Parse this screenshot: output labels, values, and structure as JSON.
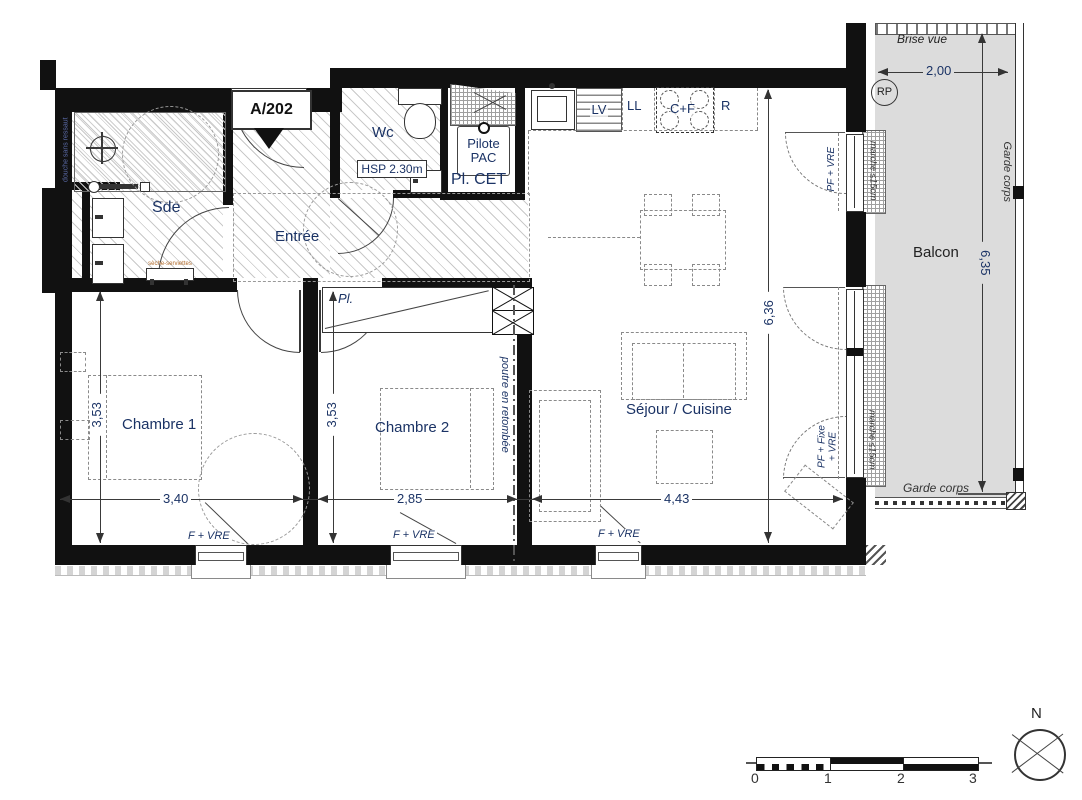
{
  "unit": {
    "label": "A/202"
  },
  "rooms": {
    "sde": "Sde",
    "entree": "Entrée",
    "wc": "Wc",
    "sejour": "Séjour / Cuisine",
    "chambre1": "Chambre 1",
    "chambre2": "Chambre 2",
    "balcon": "Balcon"
  },
  "kitchen": {
    "lv": "LV",
    "ll": "LL",
    "cf": "C+F",
    "r": "R"
  },
  "annotations": {
    "hsp": "HSP 2.30m",
    "pilote_pac": "Pilote PAC",
    "pl_cet": "Pl. CET",
    "pl": "Pl.",
    "poutre": "poutre en retombée",
    "douche": "douche sans ressaut",
    "seche": "sèche-serviettes",
    "brise_vue": "Brise vue",
    "garde_corps_right": "Garde corps",
    "garde_corps_bottom": "Garde corps",
    "rp": "RP",
    "marche_top": "marche ≤15cm",
    "marche_bottom": "marche ≤15cm",
    "pf_vre": "PF + VRE",
    "pf_fixe_vre_1": "PF + Fixe",
    "pf_fixe_vre_2": "+ VRE",
    "f_vre_1": "F + VRE",
    "f_vre_2": "F + VRE",
    "f_vre_3": "F + VRE"
  },
  "dimensions": {
    "ch1_h": "3,53",
    "ch1_w": "3,40",
    "ch2_h": "3,53",
    "ch2_w": "2,85",
    "sej_w": "4,43",
    "sej_h": "6,36",
    "bal_w": "2,00",
    "bal_h": "6,35"
  },
  "scale_bar": {
    "ticks": [
      "0",
      "1",
      "2",
      "3"
    ]
  },
  "compass": {
    "north": "N"
  },
  "colors": {
    "wall": "#111111",
    "label_navy": "#1b3365",
    "balcony_fill": "#dcdcdc",
    "annotation_blue": "#5b6ba8",
    "annotation_orange": "#b06a2a"
  }
}
